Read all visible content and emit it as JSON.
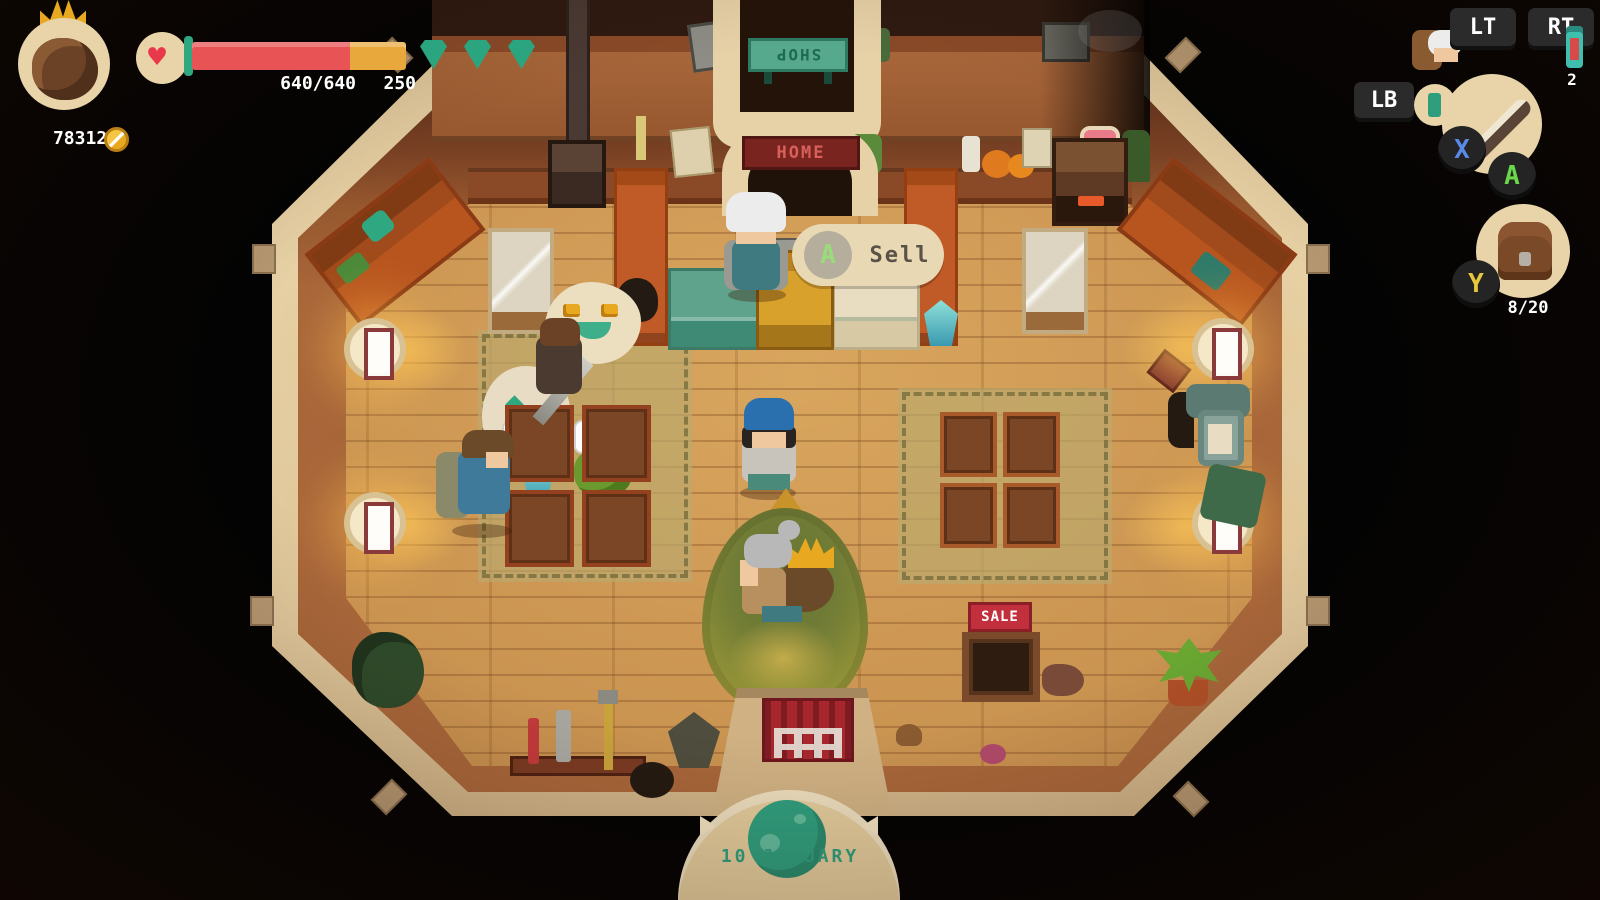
{
  "hud": {
    "gold": "783127",
    "health": {
      "value": "640/640",
      "shield": "250",
      "gem_count": "3"
    },
    "controls": {
      "lt": "LT",
      "rt": "RT",
      "lb": "LB",
      "x": "X",
      "a": "A",
      "y": "Y",
      "potion_count": "2",
      "inventory_count": "8/20"
    }
  },
  "interaction_prompt": {
    "button": "A",
    "label": "Sell"
  },
  "price_tags": [
    {
      "value": "126"
    },
    {
      "value": "2221"
    }
  ],
  "signs": {
    "shop": "SHOP",
    "home": "HOME",
    "sale": "SALE"
  },
  "date_banner": {
    "label": "10 JANUARY"
  },
  "icons": [
    "heart-icon",
    "coin-icon",
    "gem-icon",
    "crown-icon",
    "potion-icon",
    "sword-icon",
    "amulet-icon",
    "backpack-icon",
    "moon-icon",
    "a-button-icon",
    "happy-emote-icon"
  ],
  "colors": {
    "health_red": "#e85456",
    "shield_amber": "#e9a83b",
    "gem_green": "#2ba57f",
    "teal_sign": "#57a98d",
    "sale_red": "#c22f3d",
    "gold": "#e8a81f",
    "date_teal": "#2f9e7d",
    "floor_wood": "#c8914f",
    "rim_cream": "#e6d0a4"
  }
}
